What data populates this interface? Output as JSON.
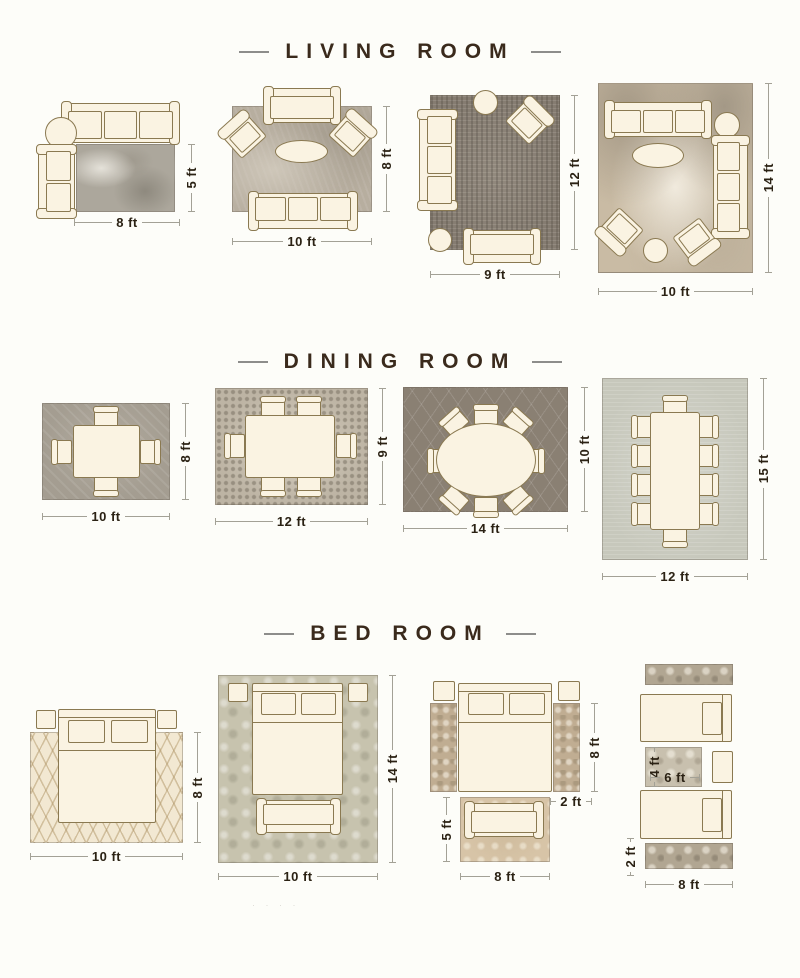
{
  "colors": {
    "background": "#fdfdf9",
    "title_text": "#3a2a1c",
    "dimension_text": "#2b2214",
    "dimension_line": "#a3a196",
    "furniture_fill": "#faf3e2",
    "furniture_outline": "#8a7951"
  },
  "watermark": "· · · ·",
  "sections": [
    {
      "title": "LIVING ROOM",
      "layouts": [
        {
          "id": "living-8x5",
          "width_label": "8 ft",
          "height_label": "5 ft",
          "rug": "gray abstract rug",
          "furniture": [
            "three-seat-sofa",
            "round-side-table",
            "loveseat"
          ]
        },
        {
          "id": "living-10x8",
          "width_label": "10 ft",
          "height_label": "8 ft",
          "rug": "taupe textured rug",
          "furniture": [
            "sofa",
            "angled-armchair",
            "angled-armchair",
            "oval-coffee-table",
            "three-seat-sofa"
          ]
        },
        {
          "id": "living-9x12",
          "width_label": "9 ft",
          "height_label": "12 ft",
          "rug": "charcoal vintage rug",
          "furniture": [
            "round-side-table",
            "angled-armchair",
            "three-seat-sofa",
            "round-ottoman",
            "loveseat"
          ]
        },
        {
          "id": "living-10x14",
          "width_label": "10 ft",
          "height_label": "14 ft",
          "rug": "beige abstract rug",
          "furniture": [
            "three-seat-sofa",
            "round-ottoman",
            "oval-coffee-table",
            "three-seat-sofa",
            "angled-armchair",
            "round-side-table",
            "angled-armchair"
          ]
        }
      ]
    },
    {
      "title": "DINING ROOM",
      "layouts": [
        {
          "id": "dining-10x8",
          "width_label": "10 ft",
          "height_label": "8 ft",
          "rug": "gray rug",
          "furniture": [
            "rectangular-table",
            "4-chairs"
          ]
        },
        {
          "id": "dining-12x9",
          "width_label": "12 ft",
          "height_label": "9 ft",
          "rug": "mosaic rug",
          "furniture": [
            "rectangular-table",
            "6-chairs"
          ]
        },
        {
          "id": "dining-14x10",
          "width_label": "14 ft",
          "height_label": "10 ft",
          "rug": "dark trellis rug",
          "furniture": [
            "oval-table",
            "8-chairs"
          ]
        },
        {
          "id": "dining-12x15",
          "width_label": "12 ft",
          "height_label": "15 ft",
          "rug": "light sage rug",
          "furniture": [
            "long-rectangular-table",
            "10-chairs"
          ]
        }
      ]
    },
    {
      "title": "BED ROOM",
      "layouts": [
        {
          "id": "bed-10x8",
          "width_label": "10 ft",
          "height_label": "8 ft",
          "rug": "cream lattice rug",
          "furniture": [
            "queen-bed",
            "nightstand",
            "nightstand"
          ]
        },
        {
          "id": "bed-10x14",
          "width_label": "10 ft",
          "height_label": "14 ft",
          "rug": "sage damask rug",
          "furniture": [
            "queen-bed",
            "nightstand",
            "nightstand",
            "bench"
          ]
        },
        {
          "id": "bed-runners",
          "runner_length_label": "8 ft",
          "runner_width_label": "2 ft",
          "foot_rug_height_label": "5 ft",
          "foot_rug_width_label": "8 ft",
          "rug": "two side runners and foot rug",
          "furniture": [
            "queen-bed",
            "nightstand",
            "nightstand",
            "runner-rug",
            "runner-rug",
            "foot-rug",
            "bench"
          ]
        },
        {
          "id": "bed-twin",
          "center_rug_height_label": "4 ft",
          "center_rug_width_label": "6 ft",
          "runner_width_label": "2 ft",
          "runner_length_label": "8 ft",
          "rug": "runners and center rug",
          "furniture": [
            "runner-rug",
            "twin-bed",
            "center-rug",
            "nightstand",
            "twin-bed",
            "runner-rug"
          ]
        }
      ]
    }
  ]
}
